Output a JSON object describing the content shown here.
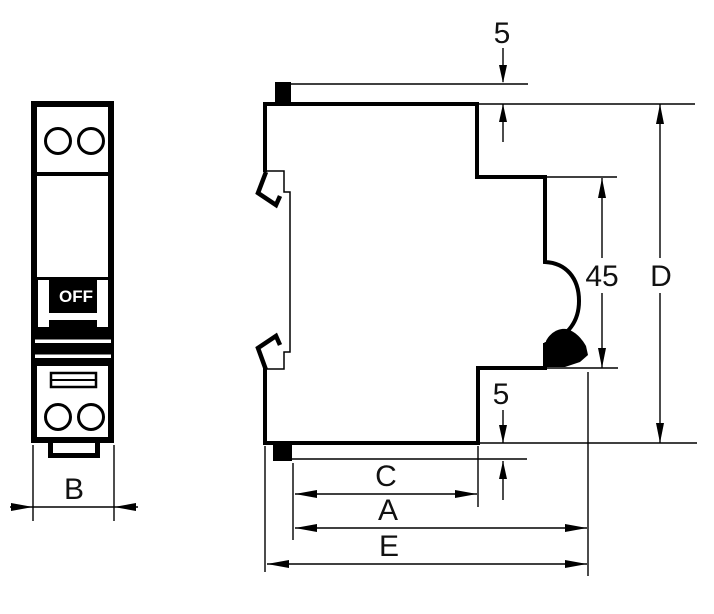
{
  "drawing": {
    "title": "circuit-breaker-dimension-drawing",
    "front_view": {
      "switch_label": "OFF"
    },
    "dimensions": {
      "top5": "5",
      "bottom5": "5",
      "h45": "45",
      "d": "D",
      "c": "C",
      "a": "A",
      "e": "E",
      "b": "B"
    },
    "colors": {
      "line": "#000000",
      "label": "#111111",
      "background": "#ffffff",
      "switch_text": "#ffffff",
      "switch_panel": "#000000"
    }
  }
}
